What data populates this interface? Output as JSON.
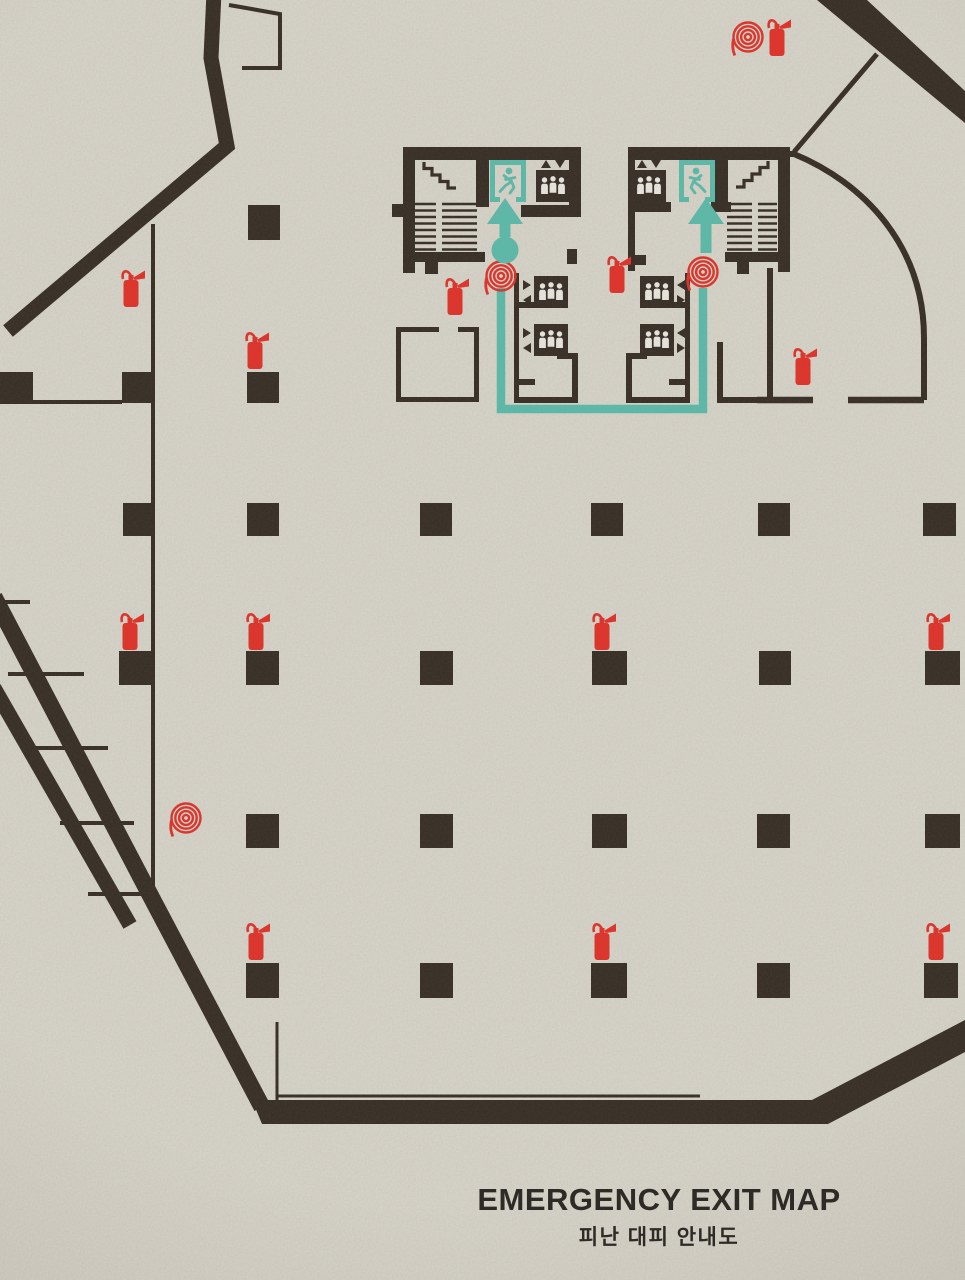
{
  "title": {
    "heading": "EMERGENCY EXIT MAP",
    "subheading": "피난 대피 안내도"
  },
  "palette": {
    "paper": "#d8d5cb",
    "ink": "#362d25",
    "safety_red": "#e23128",
    "route_teal": "#5cbcab",
    "figure_white": "#ebe9e1"
  },
  "iconography": {
    "fire-extinguisher-icon": "red cylinder body with hose horn, svg-shape",
    "fire-hose-reel-icon": "red concentric spiral with hose tail, svg-shape",
    "emergency-exit-icon": "teal running man in door frame, svg-shape",
    "elevator-icon": "dark cab with three white passengers and direction triangles, svg-shape",
    "stairs-icon": "stepped zigzag glyph, svg-shape",
    "evacuation-route": "teal line with up arrows and assembly dot",
    "structural-column": "dark filled square"
  },
  "inventory": {
    "fire_extinguisher_count": 13,
    "fire_hose_reel_count": 4,
    "emergency_exit_sign_count": 2,
    "elevator_count": 6,
    "stairwell_count": 2,
    "structural_column_count": 26,
    "evacuation_route_count": 1
  },
  "placements": {
    "fire_extinguishers": [
      [
        765,
        14
      ],
      [
        119,
        265
      ],
      [
        243,
        327
      ],
      [
        443,
        273
      ],
      [
        605,
        251
      ],
      [
        791,
        343
      ],
      [
        118,
        608
      ],
      [
        244,
        608
      ],
      [
        590,
        608
      ],
      [
        924,
        608
      ],
      [
        244,
        918
      ],
      [
        590,
        918
      ],
      [
        924,
        918
      ]
    ],
    "fire_hose_reels": [
      [
        748,
        37
      ],
      [
        501,
        276
      ],
      [
        703,
        272
      ],
      [
        186,
        818
      ]
    ],
    "exit_signs": [
      {
        "x": 490,
        "y": 160,
        "mirrored": false
      },
      {
        "x": 679,
        "y": 160,
        "mirrored": true
      }
    ],
    "stairs_glyphs": [
      {
        "x": 424,
        "y": 162,
        "mirrored": true
      },
      {
        "x": 736,
        "y": 161,
        "mirrored": false
      }
    ],
    "elevators_top": [
      [
        536,
        170
      ],
      [
        632,
        170
      ]
    ],
    "elevators_mid": [
      {
        "x": 534,
        "y": 276,
        "side": "left"
      },
      {
        "x": 534,
        "y": 324,
        "side": "left"
      },
      {
        "x": 640,
        "y": 276,
        "side": "right"
      },
      {
        "x": 640,
        "y": 324,
        "side": "right"
      }
    ],
    "route_arrows": [
      {
        "x": 505,
        "y": 198,
        "stem": 13
      },
      {
        "x": 706,
        "y": 198,
        "stem": 29
      }
    ],
    "assembly_dot": {
      "x": 505,
      "y": 250,
      "r": 13.5
    },
    "columns": [
      [
        248,
        205,
        32,
        35
      ],
      [
        0,
        372,
        33,
        31
      ],
      [
        122,
        372,
        31,
        31
      ],
      [
        247,
        372,
        32,
        31
      ],
      [
        123,
        503,
        30,
        33
      ],
      [
        247,
        503,
        32,
        33
      ],
      [
        420,
        503,
        32,
        33
      ],
      [
        591,
        503,
        32,
        33
      ],
      [
        758,
        503,
        32,
        33
      ],
      [
        923,
        503,
        33,
        33
      ],
      [
        119,
        651,
        33,
        34
      ],
      [
        246,
        651,
        33,
        34
      ],
      [
        420,
        651,
        33,
        34
      ],
      [
        592,
        651,
        35,
        34
      ],
      [
        759,
        651,
        32,
        34
      ],
      [
        925,
        651,
        35,
        34
      ],
      [
        246,
        814,
        33,
        34
      ],
      [
        420,
        814,
        33,
        34
      ],
      [
        592,
        814,
        35,
        34
      ],
      [
        757,
        814,
        33,
        34
      ],
      [
        925,
        814,
        35,
        34
      ],
      [
        246,
        963,
        33,
        35
      ],
      [
        420,
        963,
        33,
        35
      ],
      [
        591,
        963,
        36,
        35
      ],
      [
        757,
        963,
        33,
        35
      ],
      [
        924,
        963,
        34,
        35
      ]
    ]
  }
}
